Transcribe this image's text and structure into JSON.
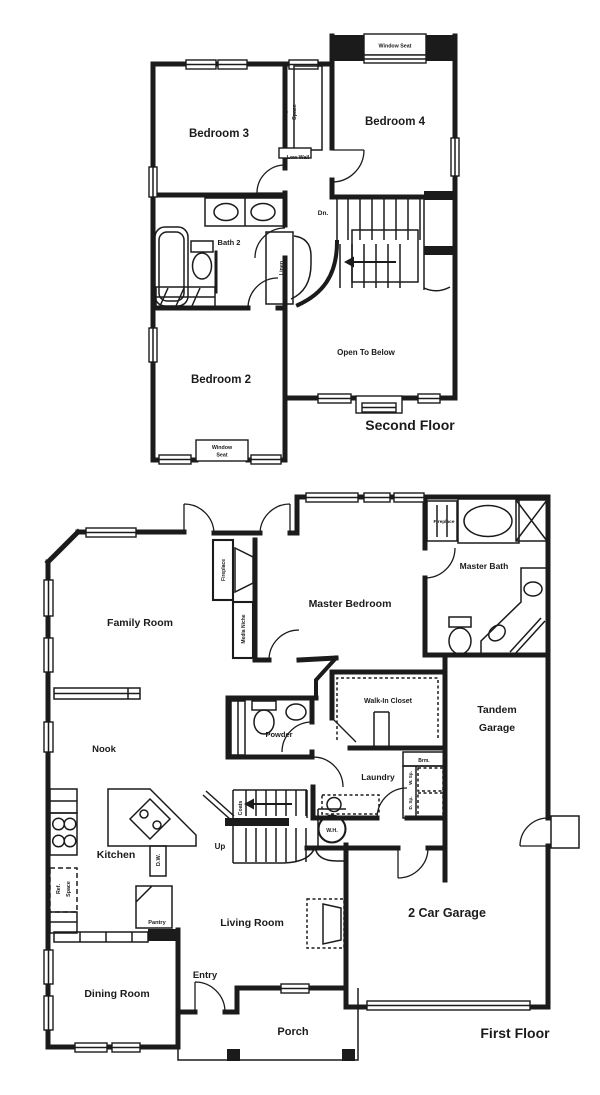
{
  "background": "#ffffff",
  "ink": "#1b1b1b",
  "second_floor": {
    "title": "Second Floor",
    "labels": {
      "bedroom3": "Bedroom 3",
      "bedroom4": "Bedroom 4",
      "bedroom2": "Bedroom 2",
      "bath2": "Bath 2",
      "computer_1": "Computer",
      "computer_2": "Space",
      "low_wall": "Low Wall",
      "linen": "Linen",
      "dn": "Dn.",
      "open_to_below": "Open To Below",
      "window_seat": "Window Seat",
      "window_seat_1": "Window",
      "window_seat_2": "Seat"
    }
  },
  "first_floor": {
    "title": "First Floor",
    "labels": {
      "family_room": "Family Room",
      "master_bedroom": "Master Bedroom",
      "master_bath": "Master Bath",
      "fireplace_family": "Fireplace",
      "fireplace_master": "Fireplace",
      "media_niche": "Media Niche",
      "walk_in_closet": "Walk-In Closet",
      "tandem_1": "Tandem",
      "tandem_2": "Garage",
      "nook": "Nook",
      "powder": "Powder",
      "laundry": "Laundry",
      "brm": "Brm.",
      "w_sp": "W. Sp.",
      "d_sp": "D. Sp.",
      "coats": "Coats",
      "up": "Up",
      "wh": "W.H.",
      "kitchen": "Kitchen",
      "dw": "D.W.",
      "ref_1": "Ref.",
      "ref_2": "Space",
      "pantry": "Pantry",
      "living_room": "Living Room",
      "car_garage": "2 Car Garage",
      "dining_room": "Dining Room",
      "entry": "Entry",
      "porch": "Porch"
    }
  }
}
